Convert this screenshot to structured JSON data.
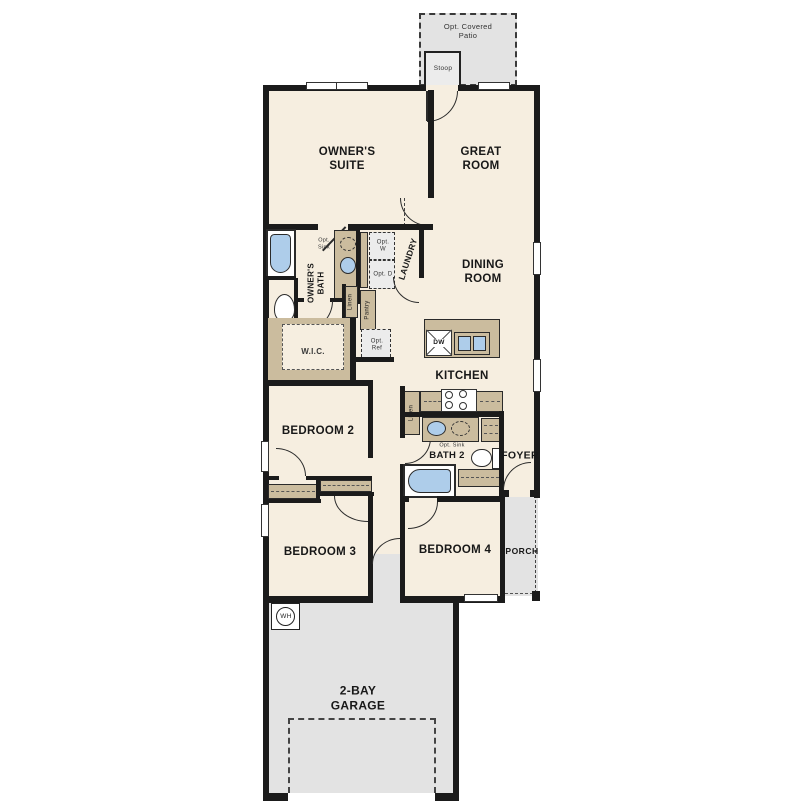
{
  "floorplan": {
    "outdoor": {
      "patio_label": "Opt. Covered Patio",
      "stoop_label": "Stoop",
      "porch_label": "PORCH"
    },
    "rooms": {
      "owners_suite": "OWNER'S SUITE",
      "great_room": "GREAT ROOM",
      "dining_room": "DINING ROOM",
      "kitchen": "KITCHEN",
      "owners_bath": "OWNER'S BATH",
      "laundry": "LAUNDRY",
      "wic": "W.I.C.",
      "bath2": "BATH 2",
      "foyer": "FOYER",
      "bedroom2": "BEDROOM 2",
      "bedroom3": "BEDROOM 3",
      "bedroom4": "BEDROOM 4",
      "garage": "2-BAY GARAGE"
    },
    "closets": {
      "linen_hall": "Linen",
      "pantry": "Pantry",
      "linen_kitchen": "Linen"
    },
    "options": {
      "opt_sink_owners": "Opt. Sink",
      "opt_washer": "Opt. W",
      "opt_dryer": "Opt. D",
      "opt_fridge": "Opt. Ref",
      "opt_sink_bath2": "Opt. Sink"
    },
    "appliances": {
      "dishwasher": "DW",
      "water_heater": "WH"
    },
    "colors": {
      "interior_floor": "#f6eee0",
      "outdoor_floor": "#e3e3e3",
      "wall": "#1b1b1b",
      "cabinet_tan": "#cbbc9e",
      "fixture_blue": "#aecdea"
    }
  }
}
